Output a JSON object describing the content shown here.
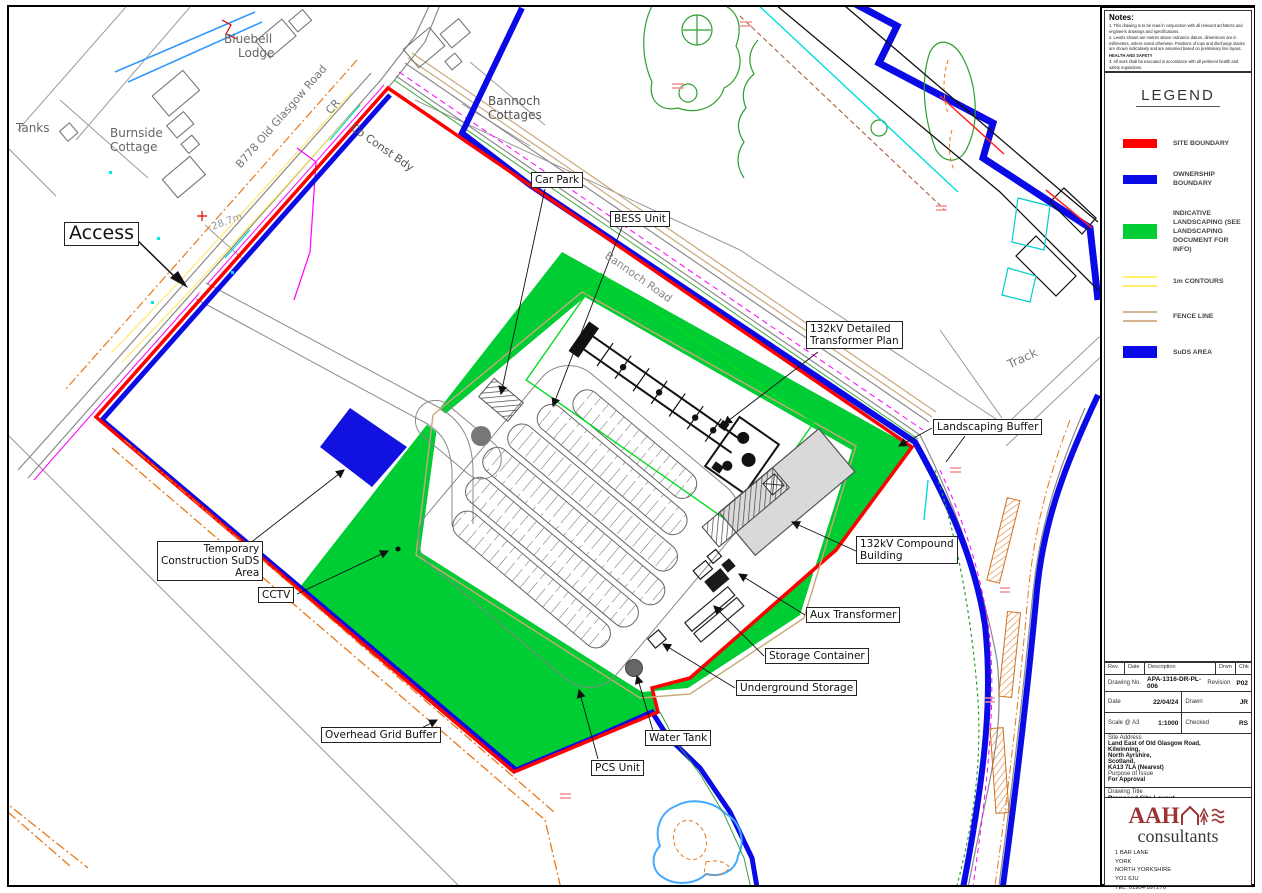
{
  "notes": {
    "title": "Notes:",
    "items": [
      "1. This drawing is to be read in conjunction with all relevant architects and engineers drawings and specifications.",
      "2. Levels shown are metres above ordnance datum, dimensions are in millimetres, unless noted otherwise. Positions of tops and discharge stacks are shown indicatively and are assumed based on preliminary line layout.",
      "HEALTH AND SAFETY",
      "3. All work shall be executed in accordance with all pertinent health and safety regulations.",
      "4. Existing below ground services are to be accurately located prior to excavation. Appropriate clearances and methods as required by the asset owners policies shall be maintained to avoid strikes, damage or undermining."
    ]
  },
  "legend": {
    "title": "LEGEND",
    "items": [
      {
        "key": "site-boundary",
        "label": "SITE BOUNDARY",
        "color": "#ff0000",
        "style": "bar"
      },
      {
        "key": "ownership-boundary",
        "label": "OWNERSHIP BOUNDARY",
        "color": "#0a0ae6",
        "style": "bar"
      },
      {
        "key": "indicative-landscaping",
        "label": "INDICATIVE LANDSCAPING (SEE LANDSCAPING DOCUMENT FOR INFO)",
        "color": "#00cc33",
        "style": "bar"
      },
      {
        "key": "1m-contours",
        "label": "1m CONTOURS",
        "color": "#ffee66",
        "style": "double-line"
      },
      {
        "key": "fence-line",
        "label": "FENCE LINE",
        "color": "#d8b48e",
        "style": "double-line"
      },
      {
        "key": "suds-area",
        "label": "SuDS AREA",
        "color": "#0a0ae6",
        "style": "bar"
      }
    ]
  },
  "title_block": {
    "header": {
      "rev": "Rev.",
      "date": "Date",
      "description": "Description",
      "drwn": "Drwn",
      "chk": "Chk"
    },
    "drawing_no_label": "Drawing No.",
    "drawing_no": "APA-1316-DR-PL-006",
    "revision_label": "Revision",
    "revision": "P02",
    "date_label": "Date",
    "date": "22/04/24",
    "drawn_label": "Drawn",
    "drawn": "JR",
    "scale_label": "Scale @ A3",
    "scale": "1:1000",
    "checked_label": "Checked",
    "checked": "RS",
    "site_address_label": "Site Address",
    "site_address": [
      "Land East of Old Glasgow Road,",
      "Kilwinning,",
      "North Ayrshire,",
      "Scotland,",
      "KA13 7LA (Nearest)"
    ],
    "purpose_label": "Purpose of Issue",
    "purpose": "For Approval",
    "drawing_title_label": "Drawing Title",
    "drawing_title": "Proposed Site Layout"
  },
  "firm": {
    "name_aah": "AAH",
    "name_consultants": "consultants",
    "address": [
      "1 BAR LANE",
      "YORK",
      "NORTH YORKSHIRE",
      "YO1 6JU",
      "TEL: 01904 897276",
      "EMAIL: INFO@AAHPLANNING.COM"
    ],
    "website": "AAHCONSULTANTS.CO.UK"
  },
  "map": {
    "callouts": {
      "access": {
        "label": "Access"
      },
      "car_park": {
        "label": "Car Park"
      },
      "bess_unit": {
        "label": "BESS Unit"
      },
      "transformer_plan": {
        "lines": [
          "132kV Detailed",
          "Transformer Plan"
        ]
      },
      "landscaping_buffer": {
        "label": "Landscaping Buffer"
      },
      "compound_building": {
        "lines": [
          "132kV Compound",
          "Building"
        ]
      },
      "aux_transformer": {
        "label": "Aux Transformer"
      },
      "storage_container": {
        "label": "Storage Container"
      },
      "underground_storage": {
        "label": "Underground Storage"
      },
      "water_tank": {
        "label": "Water Tank"
      },
      "pcs_unit": {
        "label": "PCS Unit"
      },
      "cctv": {
        "label": "CCTV"
      },
      "temp_suds": {
        "lines": [
          "Temporary",
          "Construction SuDS",
          "Area"
        ]
      },
      "overhead_grid": {
        "label": "Overhead Grid Buffer"
      }
    },
    "place_labels": {
      "bluebell": {
        "lines": [
          "Bluebell",
          "Lodge"
        ]
      },
      "tanks": {
        "label": "Tanks"
      },
      "burnside": {
        "lines": [
          "Burnside",
          "Cottage"
        ]
      },
      "bannoch_cottages": {
        "lines": [
          "Bannoch",
          "Cottages"
        ]
      },
      "road_b778": {
        "label": "B778 Old Glasgow Road"
      },
      "cr": {
        "label": "CR"
      },
      "co_const_bdy": {
        "label": "Co Const Bdy"
      },
      "bannoch_road": {
        "label": "Bannoch Road"
      },
      "track": {
        "label": "Track"
      },
      "spot_height": {
        "label": "28.7m"
      }
    },
    "colors": {
      "site_boundary": "#ff0000",
      "ownership_boundary": "#0a0ae6",
      "landscaping": "#00cc33",
      "suds": "#1212e0",
      "contours": "#ffee66",
      "fence": "#c8a878",
      "pond": "#44aaff"
    }
  }
}
